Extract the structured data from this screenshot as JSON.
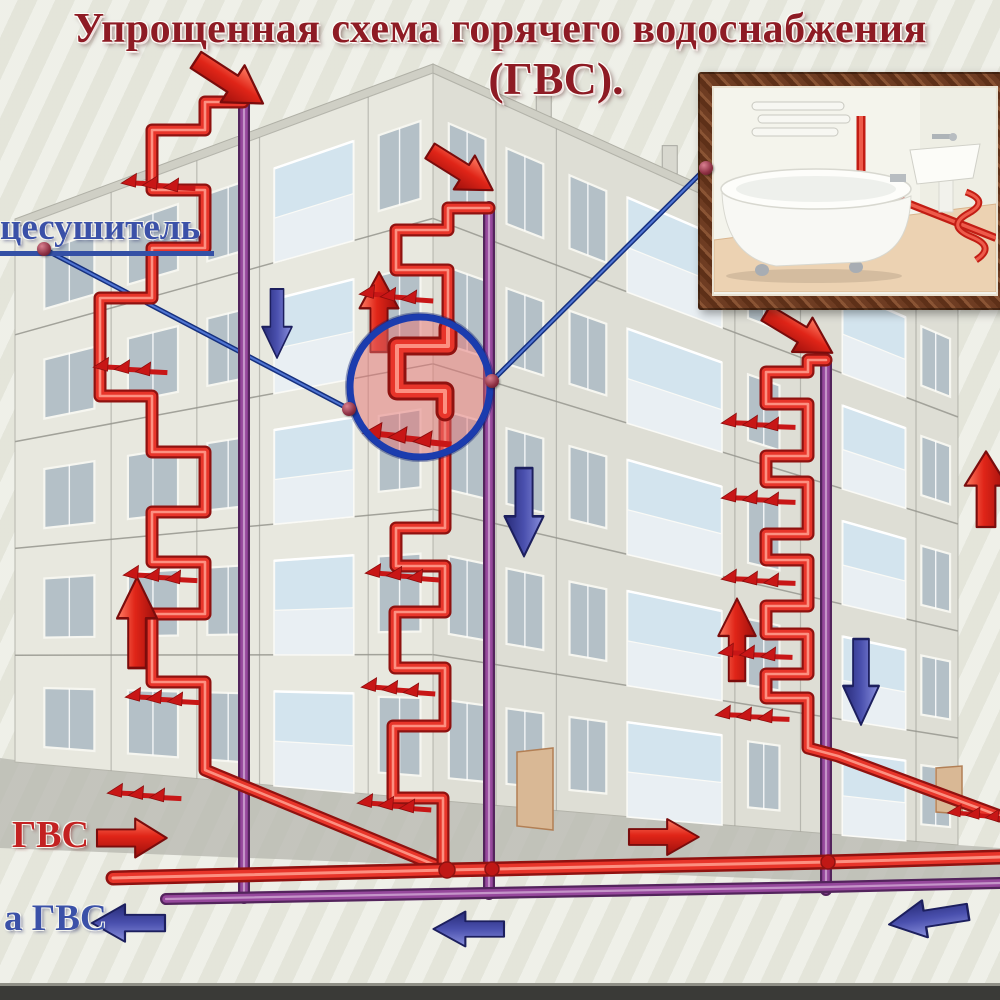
{
  "title": {
    "line1": "Упрощенная схема горячего водоснабжения",
    "line2": "(ГВС)."
  },
  "callouts": {
    "towel_dryer_label": "цесушитель"
  },
  "legend": {
    "supply_label": "ГВС",
    "return_label": "а ГВС"
  },
  "colors": {
    "supply_pipe": "#e8352a",
    "return_pipe": "#96489c",
    "supply_arrow": "#d81a1a",
    "return_arrow": "#4a50ae",
    "title_text": "#8e1b24",
    "blue_label_text": "#3b51a8",
    "red_label_text": "#c32222",
    "background": "#e9eae0",
    "magnifier_ring": "#1b3cae",
    "magnifier_fill": "rgba(228,112,112,0.5)"
  },
  "icons": {
    "supply_flow_arrow": "solid red 3D arrow",
    "return_flow_arrow": "solid blue 3D arrow",
    "heat_arrows": "triple small red arrows",
    "magnifier": "blue circle lens over towel dryer coil",
    "connector_dot": "maroon ball marker",
    "photo_inset": "framed bathroom photo"
  }
}
